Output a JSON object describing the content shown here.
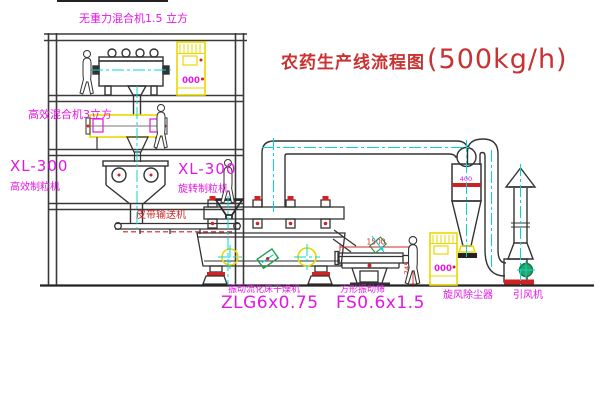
{
  "title": {
    "text": "农药生产线流程图",
    "capacity": "(500kg/h)"
  },
  "equipment_labels": {
    "gravity_mixer": "无重力混合机1.5 立方",
    "mixer2": "高效混合机3立方",
    "granulator_left_model": "XL-300",
    "granulator_left_name": "高效制粒机",
    "granulator_right_model": "XL-300",
    "granulator_right_name": "旋转制粒机",
    "belt_conveyor": "皮带输送机",
    "dryer_name": "振动流化床干燥机",
    "dryer_model": "ZLG6x0.75",
    "sieve_name": "方形振动筛",
    "sieve_model": "FS0.6x1.5",
    "cyclone": "旋风除尘器",
    "fan": "引风机"
  },
  "panel_display": "000",
  "dimensions": {
    "sieve_length": "1500",
    "sieve_height": "745",
    "cyclone_diameter": "400"
  },
  "colors": {
    "label_magenta": "#e316e3",
    "annotation_red": "#cc2a2a",
    "centerline_cyan": "#00d8d8",
    "equipment_yellow": "#e8d800",
    "line_black": "#333333"
  }
}
